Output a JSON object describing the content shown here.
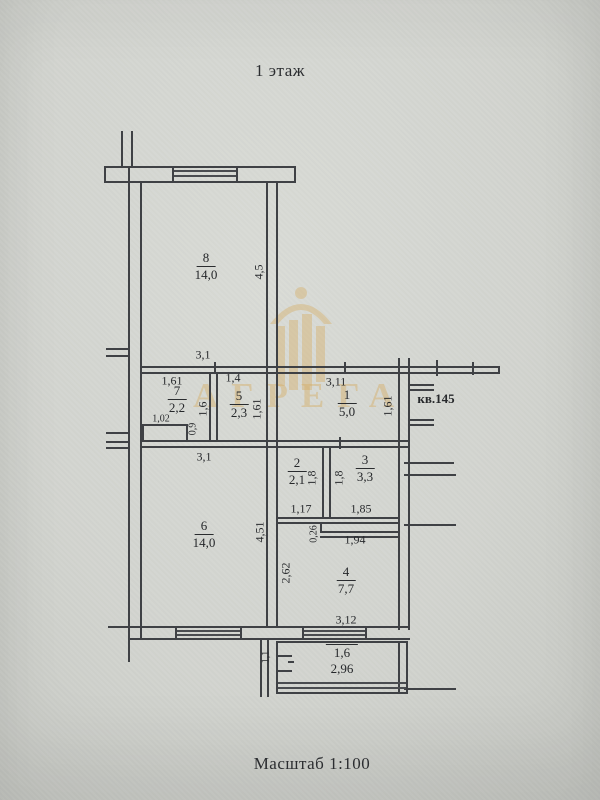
{
  "title": "1 этаж",
  "scale": "Масштаб 1:100",
  "apartment": "кв.145",
  "watermark": "АГРЕГА",
  "colors": {
    "line": "#3f4145",
    "paper": "#d3d5d0",
    "watermark": "#d6ae66"
  },
  "rooms": {
    "r8": {
      "number": "8",
      "area": "14,0"
    },
    "r7": {
      "number": "7",
      "area": "2,2"
    },
    "r5": {
      "number": "5",
      "area": "2,3"
    },
    "r1": {
      "number": "1",
      "area": "5,0"
    },
    "r2": {
      "number": "2",
      "area": "2,1"
    },
    "r3": {
      "number": "3",
      "area": "3,3"
    },
    "r6": {
      "number": "6",
      "area": "14,0"
    },
    "r4": {
      "number": "4",
      "area": "7,7"
    },
    "balcony": {
      "area": "1,6",
      "width": "2,96"
    }
  },
  "dims": {
    "r8_height": "4,5",
    "r8_width": "3,1",
    "r7_top": "1,61",
    "r7_right": "1,6",
    "r7_niche_w": "1,02",
    "r7_niche_h": "0,9",
    "r5_top": "1,4",
    "r5_right": "1,61",
    "r1_top": "3,11",
    "r1_right": "1,61",
    "r2_right": "1,8",
    "r2_bottom": "1,17",
    "r3_left": "1,8",
    "r3_bottom": "1,85",
    "r4_step": "0,26",
    "r4_top": "1,94",
    "r4_left": "2,62",
    "r4_bottom": "3,12",
    "r6_top": "3,1",
    "r6_right": "4,51",
    "balcony_door": "1,1"
  }
}
